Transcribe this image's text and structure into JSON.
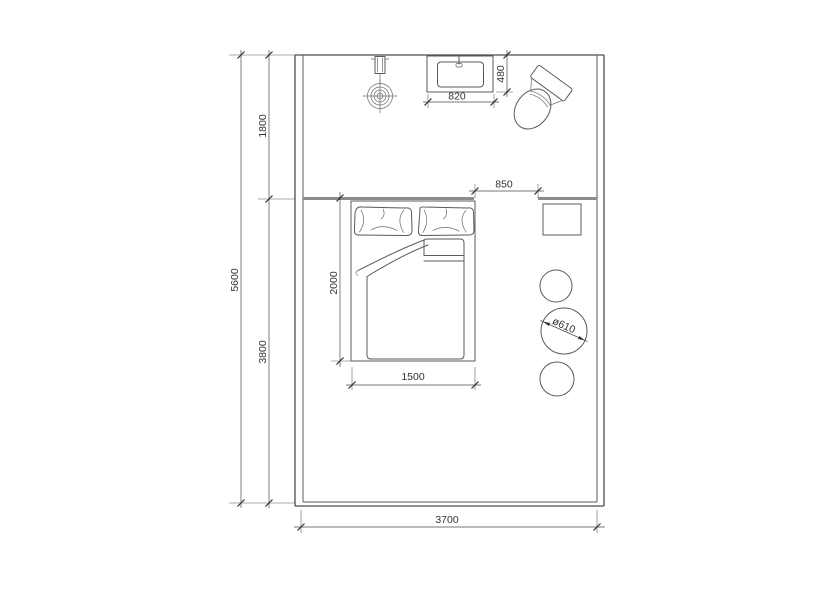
{
  "drawing": {
    "type": "bedroom-floor-plan",
    "colors": {
      "background": "#ffffff",
      "wall_line": "#4d4d4d",
      "partition_line": "#8c8c8c",
      "furniture_line": "#5a5a5a",
      "dimension_text": "#333333"
    },
    "dimensions": {
      "room_depth_total": "5600",
      "bath_zone_depth": "1800",
      "sleep_zone_depth": "3800",
      "room_width": "3700",
      "basin_width": "820",
      "basin_depth": "480",
      "opening_width": "850",
      "bed_length": "2000",
      "bed_width": "1500",
      "table_diameter": "ø610"
    }
  }
}
